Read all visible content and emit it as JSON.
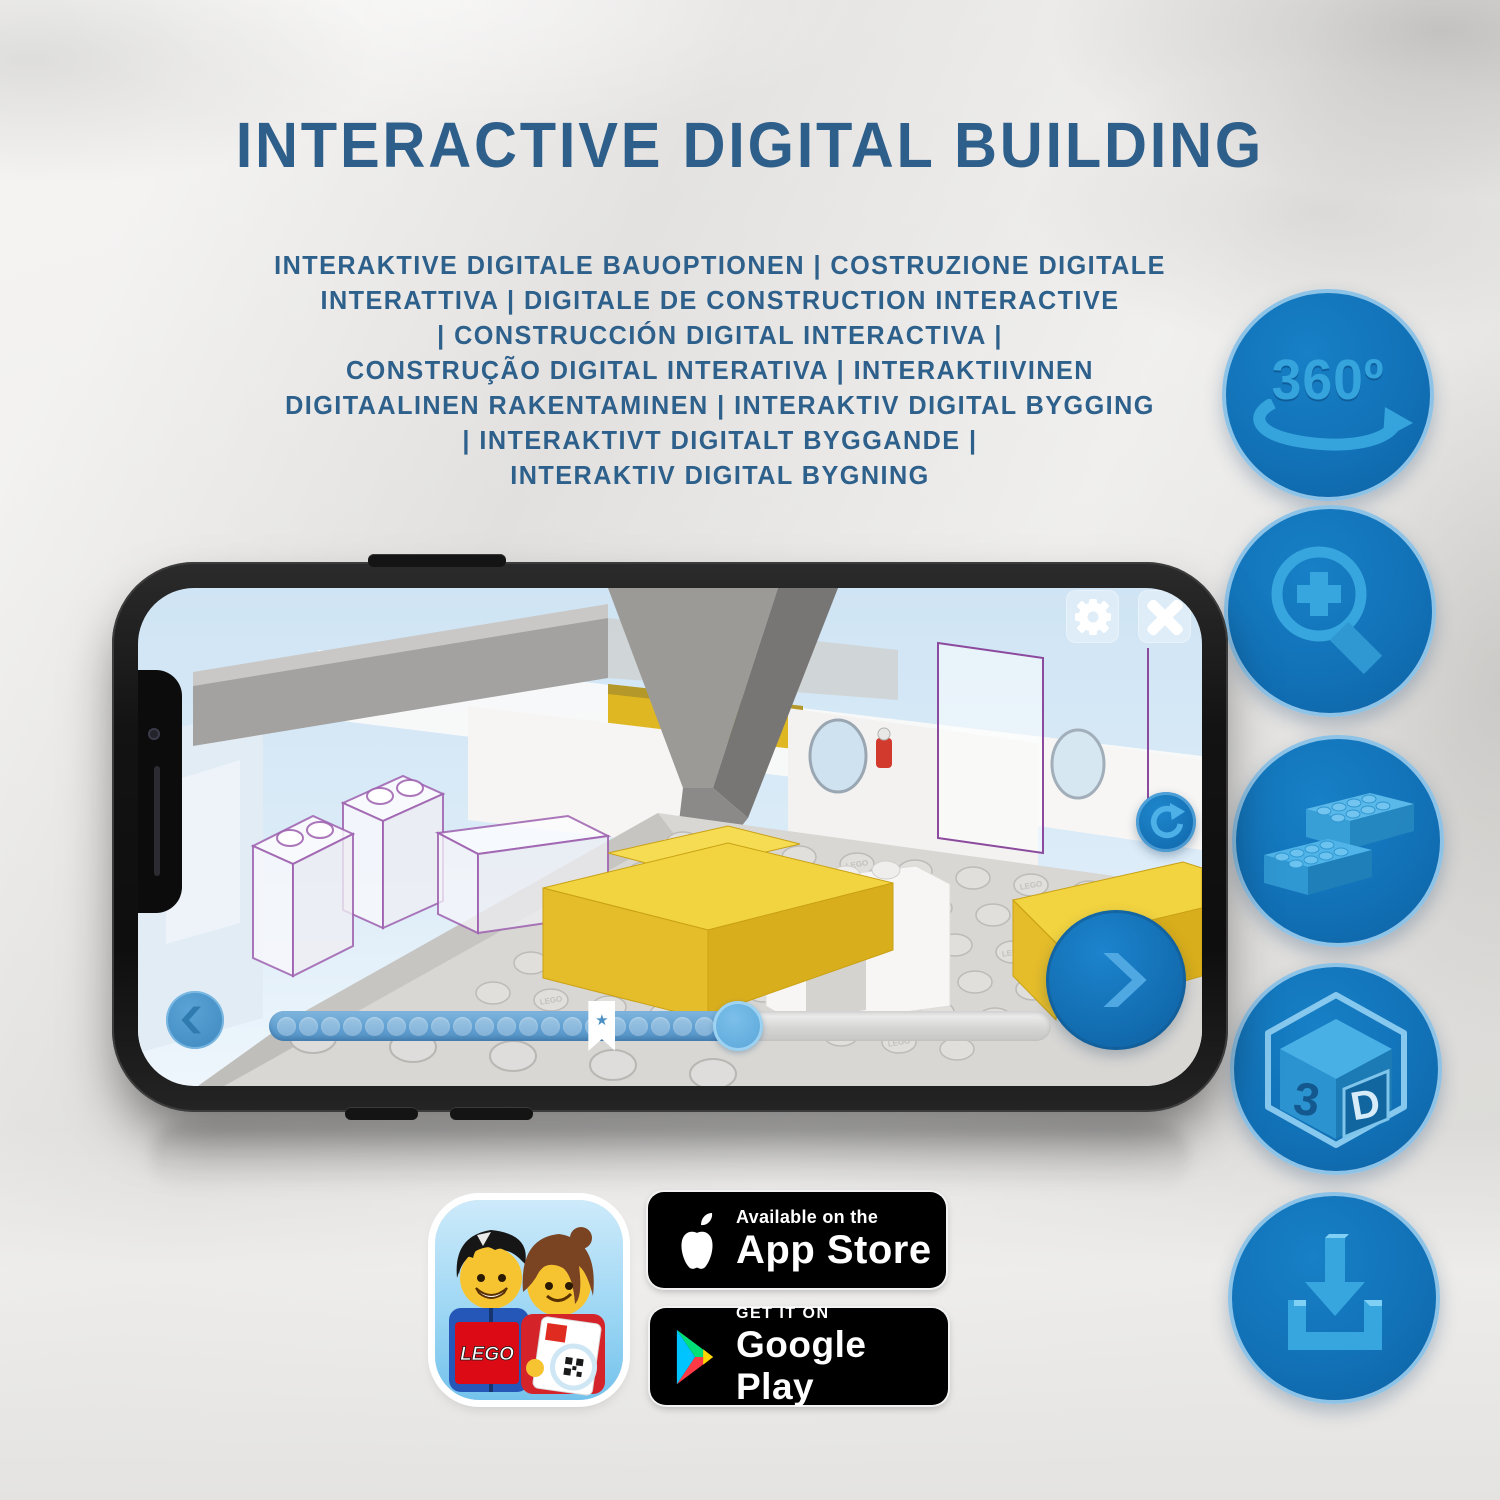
{
  "header": {
    "title": "INTERACTIVE DIGITAL BUILDING",
    "subtitle_lines": [
      "INTERAKTIVE DIGITALE BAUOPTIONEN | COSTRUZIONE DIGITALE",
      "INTERATTIVA | DIGITALE DE CONSTRUCTION INTERACTIVE",
      "| CONSTRUCCIÓN DIGITAL INTERACTIVA |",
      "CONSTRUÇÃO DIGITAL INTERATIVA | INTERAKTIIVINEN",
      "DIGITAALINEN RAKENTAMINEN | INTERAKTIV DIGITAL BYGGING",
      "| INTERAKTIVT DIGITALT BYGGANDE |",
      "INTERAKTIV DIGITAL BYGNING"
    ],
    "text_color": "#2e5f8a"
  },
  "sidebar": {
    "circle_fill": "#1272b8",
    "circle_border": "#8ec3e8",
    "icon_color": "#38a6de",
    "rotation_badge_label": "360º",
    "cube_face_left": "3",
    "cube_face_right": "D"
  },
  "phone": {
    "screen": {
      "stud_text": "LEGO",
      "progress": {
        "dot_count": 21,
        "filled_percent": 60,
        "bookmark_percent": 42.5
      },
      "accent_blue": "#1573bd",
      "highlight_yellow": "#f2d440"
    }
  },
  "store": {
    "app_icon": {
      "logo_text": "LEGO"
    },
    "app_store_badge": {
      "line1": "Available on the",
      "line2": "App Store"
    },
    "google_play_badge": {
      "line1": "GET IT ON",
      "line2": "Google Play"
    }
  }
}
